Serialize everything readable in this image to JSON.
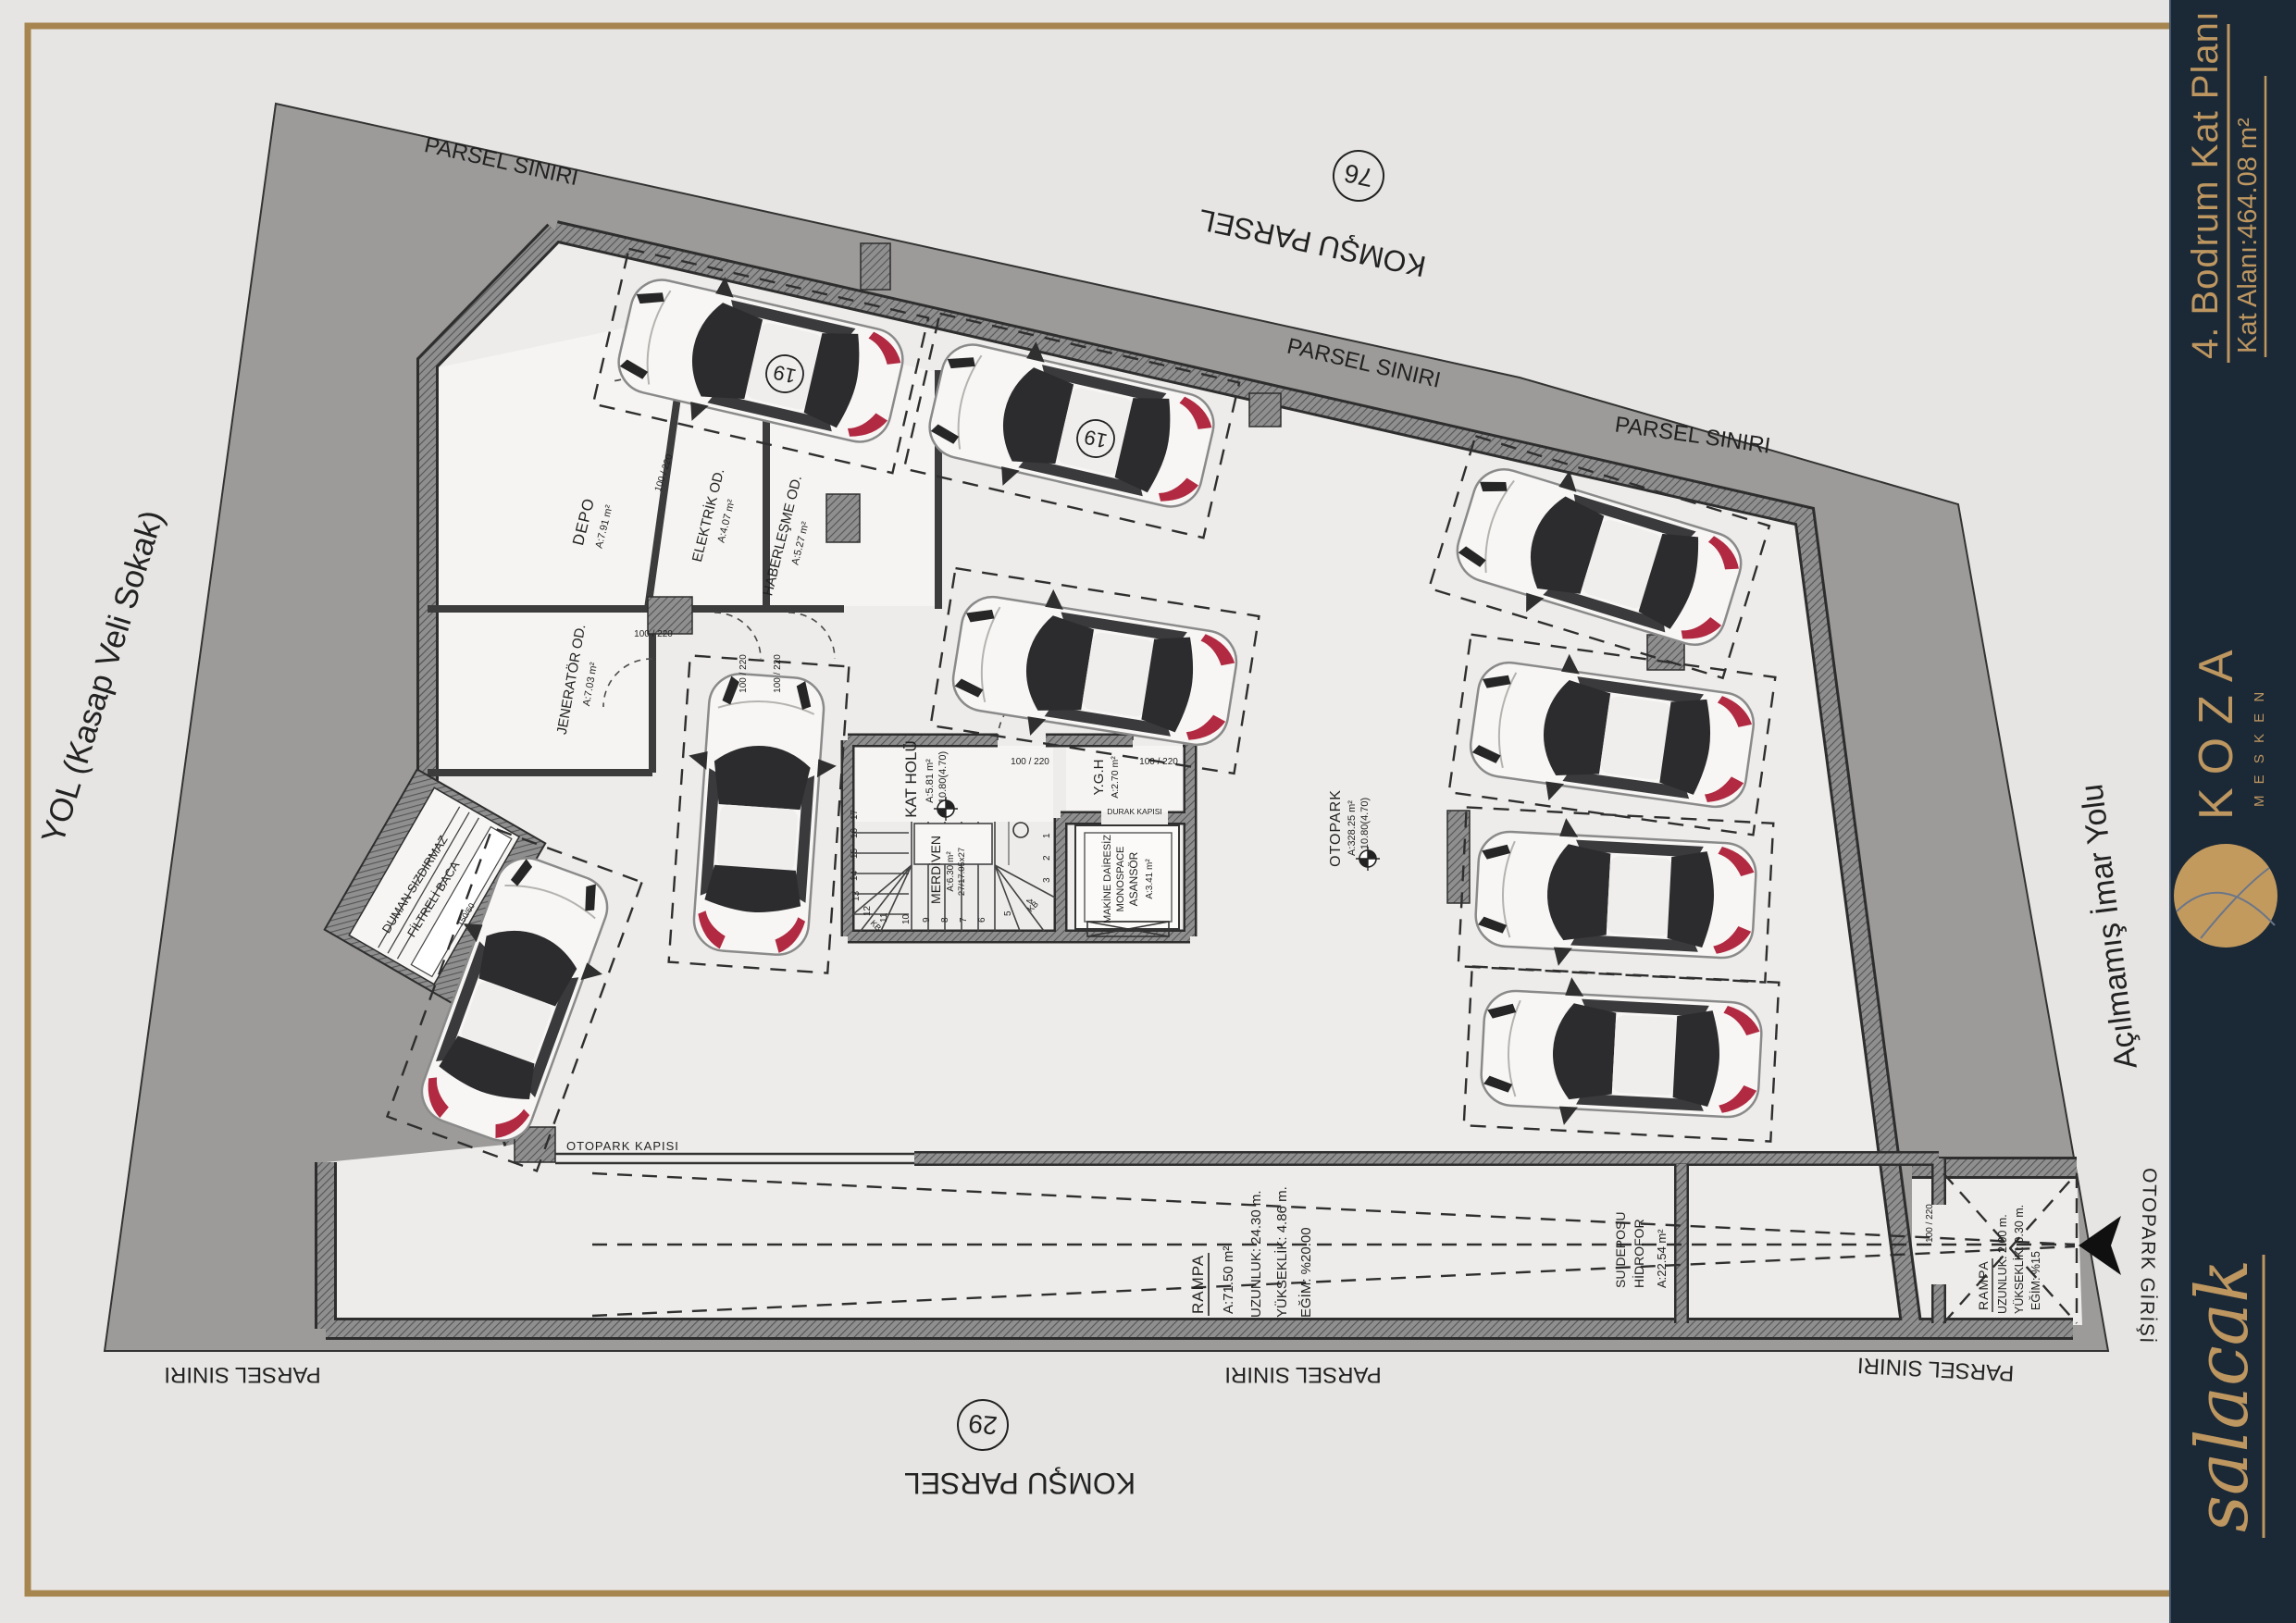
{
  "sidebar": {
    "title": "4. Bodrum Kat Planı",
    "subtitle": "Kat Alanı:464.08 m²",
    "brand": "KOZA",
    "brand_sub": "M E S K E N",
    "signature": "salacak",
    "bg": "#1b2937",
    "gold": "#bd9660"
  },
  "site": {
    "parcel_boundary": "PARSEL SINIRI",
    "neighbor_parcel": "KOMŞU PARSEL",
    "parcel_no_top": "76",
    "parcel_no_bottom": "29",
    "road_left": "YOL (Kasap Veli Sokak)",
    "road_right": "Açılmamış İmar Yolu",
    "entrance": "OTOPARK GİRİŞİ"
  },
  "rooms": {
    "depo": {
      "name": "DEPO",
      "area": "A:7.91 m²"
    },
    "elektrik": {
      "name": "ELEKTRİK OD.",
      "area": "A:4.07 m²"
    },
    "haberlesme": {
      "name": "HABERLEŞME OD.",
      "area": "A:5.27 m²"
    },
    "jenerator": {
      "name": "JENERATÖR OD.",
      "area": "A:7.03 m²"
    },
    "kat_holu": {
      "name": "KAT HOLÜ",
      "area": "A:5.81 m²",
      "level": "10.80(4.70)"
    },
    "ygh": {
      "name": "Y.G.H",
      "area": "A:2.70 m²"
    },
    "merdiven": {
      "name": "MERDİVEN",
      "area": "A:6.30 m²",
      "detail": "27/17.05x27"
    },
    "asansor": {
      "line1": "MAKİNE DAİRESİZ",
      "line2": "MONOSPACE",
      "line3": "ASANSÖR",
      "area": "A:3.41 m²",
      "door": "DURAK KAPISI"
    },
    "otopark": {
      "name": "OTOPARK",
      "area": "A:328.25 m²",
      "level": "10.80(4.70)"
    },
    "su_deposu": {
      "line1": "SU DEPOSU",
      "line2": "HİDROFOR",
      "area": "A:22.54 m²"
    }
  },
  "ramp": {
    "title": "RAMPA",
    "area": "A:71.50 m²",
    "length": "UZUNLUK: 24.30 m.",
    "height": "YÜKSEKLİK: 4.86 m.",
    "slope": "EĞİM: %20.00"
  },
  "ramp_entry": {
    "title": "RAMPA",
    "length": "UZUNLUK: 2.00 m.",
    "height": "YÜKSEKLİK: 0.30 m.",
    "slope": "EĞİM: %15"
  },
  "annotations": {
    "garage_door": "OTOPARK KAPISI",
    "chimney_line1": "DUMAN SIZDIRMAZ",
    "chimney_line2": "FİLTRELİ BACA",
    "chimney_size": "150/60",
    "door_size": "100 / 220",
    "spot_number": "19"
  },
  "stairs": {
    "steps": [
      "1",
      "2",
      "3",
      "4",
      "5",
      "6",
      "7",
      "8",
      "9",
      "10",
      "11",
      "12",
      "13",
      "14",
      "15",
      "16",
      "17"
    ],
    "kb": "KB"
  }
}
